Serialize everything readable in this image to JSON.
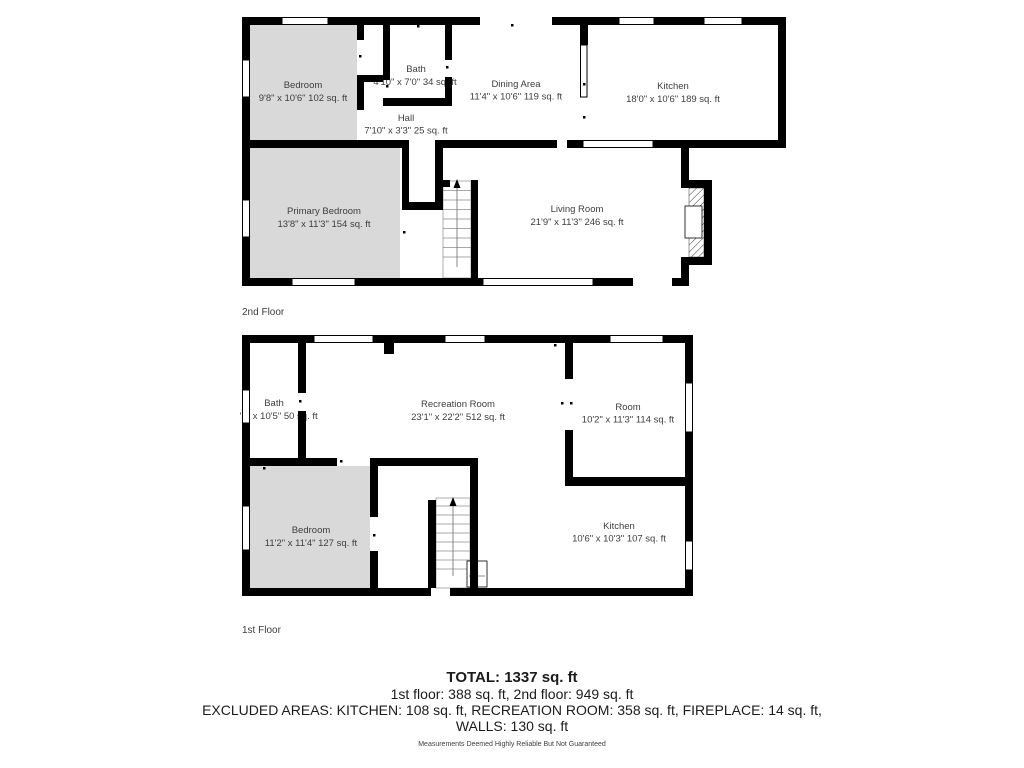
{
  "floors": [
    {
      "floor_label": "2nd Floor",
      "rooms": [
        {
          "name": "Bedroom",
          "dims": "9'8\" x 10'6\" 102 sq. ft"
        },
        {
          "name": "Bath",
          "dims": "4'10\" x 7'0\" 34 sq. ft"
        },
        {
          "name": "Dining Area",
          "dims": "11'4\" x 10'6\" 119 sq. ft"
        },
        {
          "name": "Kitchen",
          "dims": "18'0\" x 10'6\" 189 sq. ft"
        },
        {
          "name": "Hall",
          "dims": "7'10\" x 3'3\" 25 sq. ft"
        },
        {
          "name": "Primary Bedroom",
          "dims": "13'8\" x 11'3\" 154 sq. ft"
        },
        {
          "name": "Living Room",
          "dims": "21'9\" x 11'3\" 246 sq. ft"
        }
      ]
    },
    {
      "floor_label": "1st Floor",
      "rooms": [
        {
          "name": "Bath",
          "dims": "4'9\" x 10'5\" 50 sq. ft"
        },
        {
          "name": "Recreation Room",
          "dims": "23'1\" x 22'2\" 512 sq. ft"
        },
        {
          "name": "Room",
          "dims": "10'2\" x 11'3\" 114 sq. ft"
        },
        {
          "name": "Bedroom",
          "dims": "11'2\" x 11'4\" 127 sq. ft"
        },
        {
          "name": "Kitchen",
          "dims": "10'6\" x 10'3\" 107 sq. ft"
        }
      ]
    }
  ],
  "summary": {
    "total": "TOTAL: 1337 sq. ft",
    "floors_line": "1st floor: 388 sq. ft, 2nd floor: 949 sq. ft",
    "excluded_line": "EXCLUDED AREAS: KITCHEN: 108 sq. ft, RECREATION ROOM: 358 sq. ft, FIREPLACE: 14 sq. ft,",
    "walls_line": "WALLS: 130 sq. ft",
    "disclaimer": "Measurements Deemed Highly Reliable But Not Guaranteed"
  },
  "colors": {
    "wall": "#000000",
    "room_fill": "#d9d9d9",
    "label_text": "#3d3d3d"
  }
}
